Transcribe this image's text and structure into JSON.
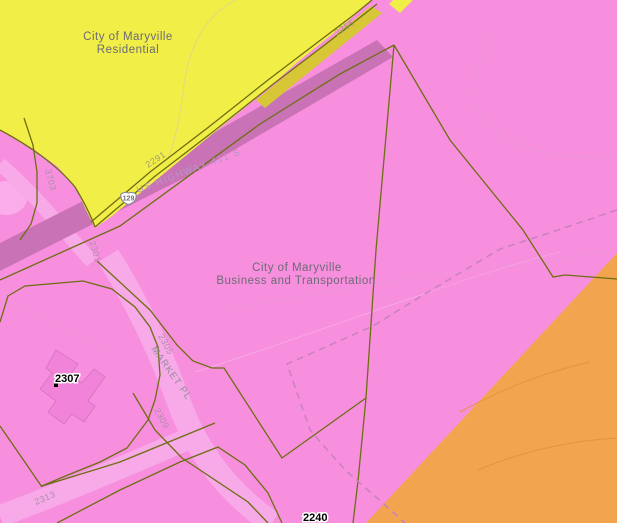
{
  "title": "City of Maryville zoning map",
  "colors": {
    "background_pink": "#F78FDE",
    "residential_yellow": "#F1EE48",
    "residential_edge_gold": "#D7C737",
    "orange_zone": "#F3A44F",
    "highway_band": "#C973B6",
    "street_band": "#F7A9E8",
    "parcel_line_olive": "#6E6D12",
    "dashed_line": "#C880BE",
    "zone_text_gray": "#6B6B75",
    "road_text": "#B795C5",
    "street_text": "#8F8F99",
    "parcel_text_on_yellow": "#A3A06B",
    "parcel_text_on_pink": "#AD8FA9",
    "address_text": "#000000",
    "building_fill": "#F183D9",
    "building_stroke": "#D976C4",
    "contour_on_yellow": "#DFDB7E",
    "contour_on_pink": "#E49FD6",
    "contour_on_orange": "#E0953F",
    "shield_fill": "#FFFFFF",
    "shield_stroke": "#8A8A94"
  },
  "zones": {
    "residential": {
      "name_line1": "City of Maryville",
      "name_line2": "Residential"
    },
    "business": {
      "name_line1": "City of Maryville",
      "name_line2": "Business and Transportation"
    }
  },
  "roads": {
    "highway": {
      "label": "US HIGHWAY 411 S",
      "shield": "129"
    },
    "street": {
      "label": "MARKET PL"
    }
  },
  "parcels": {
    "p2255": "2255",
    "p2291": "2291",
    "p2301": "2301",
    "p3703": "3703",
    "p2305": "2305",
    "p2309": "2309",
    "p2313": "2313"
  },
  "addresses": {
    "a2307": "2307",
    "a2240": "2240"
  }
}
